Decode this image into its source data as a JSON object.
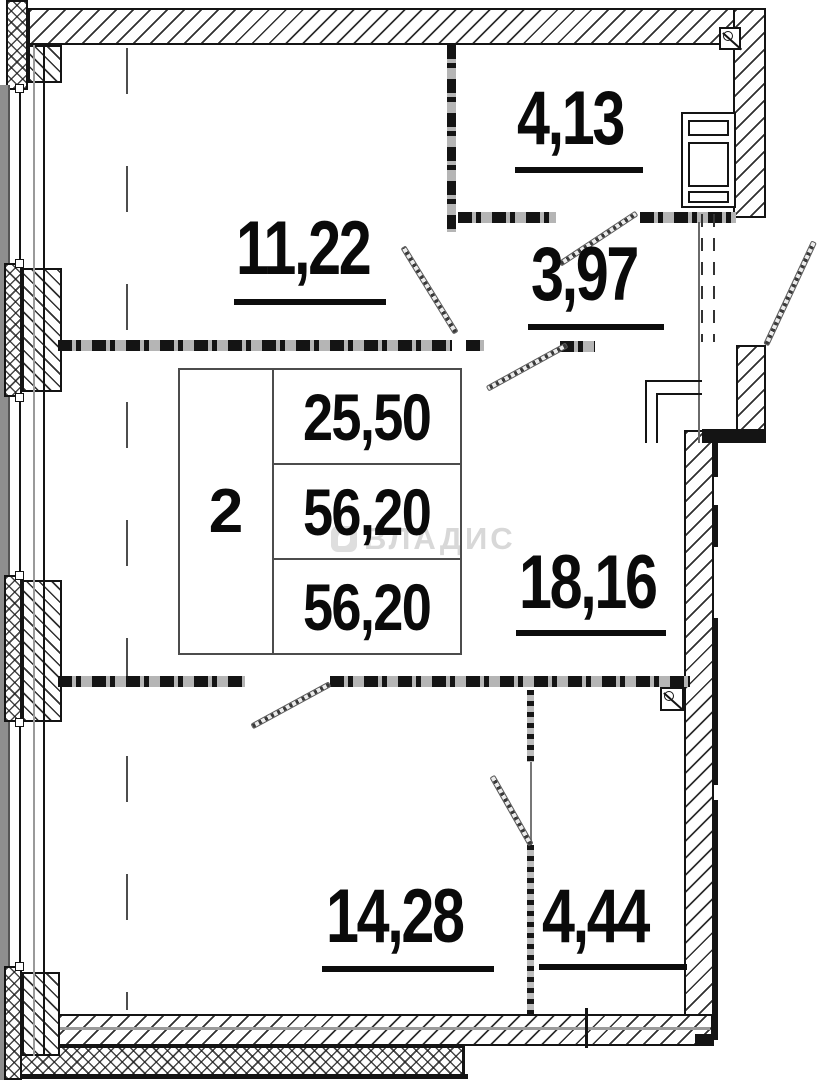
{
  "plan": {
    "type": "apartment-floor-plan",
    "watermark": {
      "text": "ВЛАДИС"
    },
    "table": {
      "count": "2",
      "rows": [
        "25,50",
        "56,20",
        "56,20"
      ]
    },
    "rooms": [
      {
        "name": "top-left-room",
        "area": "11,22"
      },
      {
        "name": "top-right-room",
        "area": "4,13"
      },
      {
        "name": "hallway",
        "area": "3,97"
      },
      {
        "name": "middle-room",
        "area": "18,16"
      },
      {
        "name": "bottom-left-room",
        "area": "14,28"
      },
      {
        "name": "bottom-right-room",
        "area": "4,44"
      }
    ],
    "colors": {
      "line": "#141414",
      "gray": "#8e8e8e",
      "watermark": "#d8d8d8",
      "paper": "#ffffff"
    }
  }
}
